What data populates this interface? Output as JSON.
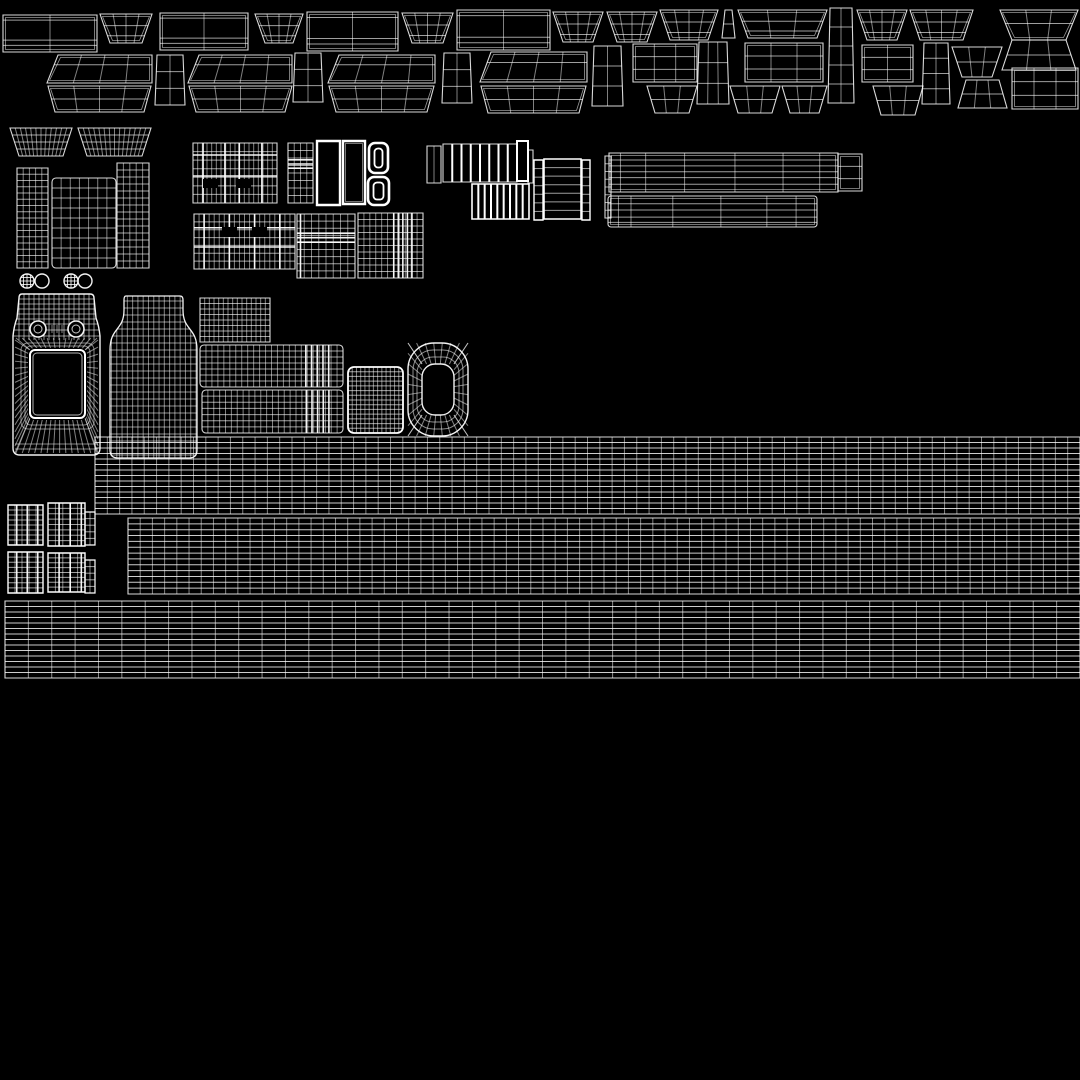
{
  "canvas": {
    "width": 1080,
    "height": 1080,
    "background": "#000000"
  },
  "style": {
    "line_color": "#ffffff",
    "border_opacity": 0.85,
    "bright_opacity": 1.0,
    "dim_opacity": 0.5,
    "row_opacity": 0.62
  },
  "shapes": [
    {
      "id": "panel-rect-1",
      "t": "rect",
      "x": 3,
      "y": 15,
      "w": 94,
      "h": 37,
      "colsAt": [
        0.5
      ],
      "rowsAt": [
        0.14,
        0.68,
        0.82
      ],
      "inset": true
    },
    {
      "id": "trapezoid-1",
      "t": "trap",
      "x": 100,
      "y": 14,
      "w": 52,
      "h": 29,
      "bi": 10,
      "colsAt": [
        0.25,
        0.5,
        0.75
      ],
      "rowsAt": [
        0.4,
        0.75
      ],
      "inset": true
    },
    {
      "id": "panel-rect-2",
      "t": "rect",
      "x": 160,
      "y": 13,
      "w": 88,
      "h": 37,
      "colsAt": [
        0.5
      ],
      "rowsAt": [
        0.14,
        0.68,
        0.82
      ],
      "inset": true
    },
    {
      "id": "trapezoid-2",
      "t": "trap",
      "x": 255,
      "y": 14,
      "w": 48,
      "h": 29,
      "bi": 10,
      "colsAt": [
        0.25,
        0.5,
        0.75
      ],
      "rowsAt": [
        0.4,
        0.75
      ],
      "inset": true
    },
    {
      "id": "panel-rect-3",
      "t": "rect",
      "x": 307,
      "y": 12,
      "w": 91,
      "h": 39,
      "colsAt": [
        0.5
      ],
      "rowsAt": [
        0.14,
        0.68,
        0.82
      ],
      "inset": true
    },
    {
      "id": "trapezoid-3",
      "t": "trap",
      "x": 402,
      "y": 13,
      "w": 51,
      "h": 30,
      "bi": 10,
      "colsAt": [
        0.25,
        0.5,
        0.75
      ],
      "rowsAt": [
        0.4,
        0.75
      ],
      "inset": true
    },
    {
      "id": "panel-rect-4",
      "t": "rect",
      "x": 457,
      "y": 10,
      "w": 93,
      "h": 40,
      "colsAt": [
        0.5
      ],
      "rowsAt": [
        0.14,
        0.68,
        0.82
      ],
      "inset": true
    },
    {
      "id": "trapezoid-4",
      "t": "trap",
      "x": 553,
      "y": 12,
      "w": 50,
      "h": 30,
      "bi": 10,
      "colsAt": [
        0.25,
        0.5,
        0.75
      ],
      "rowsAt": [
        0.4,
        0.75
      ],
      "inset": true
    },
    {
      "id": "trapezoid-5",
      "t": "trap",
      "x": 607,
      "y": 12,
      "w": 50,
      "h": 30,
      "bi": 10,
      "colsAt": [
        0.25,
        0.5,
        0.75
      ],
      "rowsAt": [
        0.4,
        0.75
      ],
      "inset": true
    },
    {
      "id": "trapezoid-6",
      "t": "trap",
      "x": 660,
      "y": 10,
      "w": 58,
      "h": 30,
      "bi": 10,
      "colsAt": [
        0.25,
        0.5,
        0.75
      ],
      "rowsAt": [
        0.4,
        0.75
      ],
      "inset": true
    },
    {
      "id": "edge-quad-1",
      "t": "trap",
      "x": 722,
      "y": 10,
      "w": 13,
      "h": 28,
      "ti": 3,
      "rows": 2
    },
    {
      "id": "trapezoid-wide-1",
      "t": "trap",
      "x": 738,
      "y": 10,
      "w": 89,
      "h": 28,
      "bi": 10,
      "colsAt": [
        0.33,
        0.66
      ],
      "rowsAt": [
        0.4,
        0.75
      ],
      "inset": true
    },
    {
      "id": "trapezoid-7",
      "t": "trap",
      "x": 857,
      "y": 10,
      "w": 50,
      "h": 30,
      "bi": 10,
      "colsAt": [
        0.25,
        0.5,
        0.75
      ],
      "rowsAt": [
        0.4,
        0.75
      ],
      "inset": true
    },
    {
      "id": "trapezoid-8",
      "t": "trap",
      "x": 910,
      "y": 10,
      "w": 63,
      "h": 30,
      "bi": 10,
      "colsAt": [
        0.25,
        0.5,
        0.75
      ],
      "rowsAt": [
        0.4,
        0.75
      ],
      "inset": true
    },
    {
      "id": "hourglass-top",
      "t": "trap",
      "x": 1000,
      "y": 10,
      "w": 78,
      "h": 30,
      "bi": 12,
      "colsAt": [
        0.33,
        0.66
      ],
      "rowsAt": [
        0.45
      ],
      "inset": true
    },
    {
      "id": "hourglass-bottom",
      "t": "trap",
      "x": 1000,
      "y": 40,
      "w": 78,
      "h": 30,
      "ti": 12,
      "bi": 2,
      "colsAt": [
        0.33,
        0.66
      ],
      "rowsAt": [
        0.5
      ]
    },
    {
      "id": "pair1-top",
      "t": "trap",
      "x": 47,
      "y": 55,
      "w": 105,
      "h": 28,
      "ti": 5.5,
      "sk": 5.5,
      "cols": 4,
      "rowsAt": [
        0.35
      ],
      "inset": true
    },
    {
      "id": "pair1-bottom",
      "t": "trap",
      "x": 48,
      "y": 86,
      "w": 103,
      "h": 26,
      "bi": 7,
      "cols": 4,
      "rowsAt": [
        0.5
      ],
      "inset": true
    },
    {
      "id": "side-quad-1",
      "t": "trap",
      "x": 155,
      "y": 55,
      "w": 30,
      "h": 50,
      "ti": 2,
      "cols": 2,
      "rows": 3
    },
    {
      "id": "pair2-top",
      "t": "trap",
      "x": 188,
      "y": 55,
      "w": 104,
      "h": 28,
      "ti": 5.5,
      "sk": 5.5,
      "cols": 4,
      "rowsAt": [
        0.35
      ],
      "inset": true
    },
    {
      "id": "pair2-bottom",
      "t": "trap",
      "x": 189,
      "y": 86,
      "w": 103,
      "h": 26,
      "bi": 7,
      "cols": 4,
      "rowsAt": [
        0.5
      ],
      "inset": true
    },
    {
      "id": "side-quad-2",
      "t": "trap",
      "x": 293,
      "y": 53,
      "w": 30,
      "h": 49,
      "ti": 2,
      "cols": 2,
      "rows": 3
    },
    {
      "id": "pair3-top",
      "t": "trap",
      "x": 328,
      "y": 55,
      "w": 107,
      "h": 28,
      "ti": 5.5,
      "sk": 5.5,
      "cols": 4,
      "rowsAt": [
        0.35
      ],
      "inset": true
    },
    {
      "id": "pair3-bottom",
      "t": "trap",
      "x": 329,
      "y": 86,
      "w": 105,
      "h": 26,
      "bi": 7,
      "cols": 4,
      "rowsAt": [
        0.5
      ],
      "inset": true
    },
    {
      "id": "side-quad-3",
      "t": "trap",
      "x": 442,
      "y": 53,
      "w": 30,
      "h": 50,
      "ti": 2,
      "cols": 2,
      "rows": 3
    },
    {
      "id": "pair4-top",
      "t": "trap",
      "x": 480,
      "y": 52,
      "w": 107,
      "h": 30,
      "ti": 5.5,
      "sk": 5.5,
      "cols": 4,
      "rowsAt": [
        0.35
      ],
      "inset": true
    },
    {
      "id": "pair4-bottom",
      "t": "trap",
      "x": 481,
      "y": 86,
      "w": 105,
      "h": 27,
      "bi": 7,
      "cols": 4,
      "rowsAt": [
        0.5
      ],
      "inset": true
    },
    {
      "id": "side-quad-4",
      "t": "trap",
      "x": 592,
      "y": 46,
      "w": 31,
      "h": 60,
      "ti": 2,
      "cols": 2,
      "rows": 3
    },
    {
      "id": "grid-rect-1",
      "t": "rect",
      "x": 633,
      "y": 44,
      "w": 64,
      "h": 38,
      "cols": 3,
      "rows": 3,
      "inset": true
    },
    {
      "id": "small-trap-1",
      "t": "trap",
      "x": 647,
      "y": 86,
      "w": 50,
      "h": 27,
      "bi": 8,
      "cols": 3,
      "rows": 2
    },
    {
      "id": "side-quad-5",
      "t": "trap",
      "x": 697,
      "y": 42,
      "w": 32,
      "h": 62,
      "ti": 2,
      "cols": 3,
      "rows": 3
    },
    {
      "id": "grid-rect-2",
      "t": "rect",
      "x": 745,
      "y": 43,
      "w": 78,
      "h": 39,
      "cols": 3,
      "rows": 3,
      "inset": true
    },
    {
      "id": "small-trap-2",
      "t": "trap",
      "x": 730,
      "y": 86,
      "w": 50,
      "h": 27,
      "bi": 8,
      "cols": 3,
      "rows": 2
    },
    {
      "id": "small-trap-3",
      "t": "trap",
      "x": 782,
      "y": 86,
      "w": 45,
      "h": 27,
      "bi": 8,
      "cols": 3,
      "rows": 2
    },
    {
      "id": "tall-panel-1",
      "t": "trap",
      "x": 828,
      "y": 8,
      "w": 26,
      "h": 95,
      "ti": 2,
      "cols": 2,
      "rows": 5
    },
    {
      "id": "grid-rect-3",
      "t": "rect",
      "x": 862,
      "y": 45,
      "w": 51,
      "h": 37,
      "cols": 2,
      "rows": 3,
      "inset": true
    },
    {
      "id": "small-trap-4",
      "t": "trap",
      "x": 873,
      "y": 86,
      "w": 50,
      "h": 29,
      "bi": 8,
      "cols": 3,
      "rows": 2
    },
    {
      "id": "tall-panel-2",
      "t": "trap",
      "x": 922,
      "y": 43,
      "w": 28,
      "h": 61,
      "ti": 2,
      "cols": 2,
      "rows": 4
    },
    {
      "id": "small-trap-5",
      "t": "trap",
      "x": 952,
      "y": 47,
      "w": 50,
      "h": 30,
      "bi": 10,
      "cols": 3,
      "rows": 2
    },
    {
      "id": "small-trap-6",
      "t": "trap",
      "x": 958,
      "y": 80,
      "w": 49,
      "h": 28,
      "ti": 8,
      "cols": 3,
      "rows": 2
    },
    {
      "id": "grid-rect-4",
      "t": "rect",
      "x": 1012,
      "y": 68,
      "w": 66,
      "h": 41,
      "cols": 3,
      "rows": 3,
      "inset": true
    },
    {
      "id": "dense-trap-1",
      "t": "trap",
      "x": 10,
      "y": 128,
      "w": 62,
      "h": 28,
      "bi": 9,
      "cols": 12,
      "rows": 4
    },
    {
      "id": "dense-trap-2",
      "t": "trap",
      "x": 78,
      "y": 128,
      "w": 73,
      "h": 28,
      "bi": 9,
      "cols": 14,
      "rows": 4
    },
    {
      "id": "curved-panel-left",
      "t": "rect",
      "x": 17,
      "y": 168,
      "w": 31,
      "h": 100,
      "cols": 5,
      "rows": 16
    },
    {
      "id": "curved-panel-mid",
      "t": "rect",
      "x": 52,
      "y": 178,
      "w": 64,
      "h": 90,
      "rx": 4,
      "cols": 7,
      "rows": 9
    },
    {
      "id": "curved-panel-right",
      "t": "rect",
      "x": 117,
      "y": 163,
      "w": 32,
      "h": 105,
      "cols": 5,
      "rows": 15
    },
    {
      "id": "eyelet-circle-1",
      "t": "circle",
      "x": 27,
      "y": 281,
      "r": 7,
      "hatch": true
    },
    {
      "id": "eyelet-circle-2",
      "t": "circle",
      "x": 42,
      "y": 281,
      "r": 7
    },
    {
      "id": "eyelet-circle-3",
      "t": "circle",
      "x": 71,
      "y": 281,
      "r": 7,
      "hatch": true
    },
    {
      "id": "eyelet-circle-4",
      "t": "circle",
      "x": 85,
      "y": 281,
      "r": 7
    },
    {
      "id": "plaid-block-a",
      "t": "rect",
      "x": 193,
      "y": 143,
      "w": 84,
      "h": 60,
      "cols": 18,
      "rows": 7,
      "colsB": [
        0.12,
        0.38,
        0.55,
        0.82
      ],
      "rowsB": [
        0.2,
        0.55
      ],
      "slots": [
        [
          10,
          36,
          15,
          9
        ],
        [
          43,
          36,
          15,
          9
        ]
      ]
    },
    {
      "id": "plaid-strip-a",
      "t": "rect",
      "x": 288,
      "y": 143,
      "w": 25,
      "h": 60,
      "cols": 4,
      "rows": 8,
      "rowsB": [
        0.28,
        0.35,
        0.42
      ]
    },
    {
      "id": "white-frame-1",
      "t": "rect",
      "x": 317,
      "y": 141,
      "w": 23,
      "h": 64,
      "b": "hi",
      "lw": 2.4
    },
    {
      "id": "white-frame-2",
      "t": "rect",
      "x": 343,
      "y": 141,
      "w": 22,
      "h": 63,
      "b": "hi",
      "lw": 2.4,
      "inset": true
    },
    {
      "id": "grommet-ring-1",
      "t": "ringrr",
      "x": 369,
      "y": 143,
      "w": 19,
      "h": 30
    },
    {
      "id": "grommet-ring-2",
      "t": "ringrr",
      "x": 368,
      "y": 177,
      "w": 21,
      "h": 28
    },
    {
      "id": "plaid-block-b",
      "t": "rect",
      "x": 194,
      "y": 214,
      "w": 101,
      "h": 55,
      "cols": 20,
      "rows": 7,
      "colsB": [
        0.1,
        0.35,
        0.6,
        0.85
      ],
      "rowsB": [
        0.25,
        0.6
      ],
      "slots": [
        [
          28,
          13,
          15,
          10
        ],
        [
          58,
          13,
          15,
          10
        ]
      ]
    },
    {
      "id": "plaid-block-c",
      "t": "rect",
      "x": 297,
      "y": 214,
      "w": 58,
      "h": 64,
      "cols": 8,
      "rows": 9,
      "colsB": [
        0.06
      ],
      "rowsB": [
        0.3,
        0.37,
        0.44
      ]
    },
    {
      "id": "plaid-block-d",
      "t": "rect",
      "x": 358,
      "y": 213,
      "w": 65,
      "h": 65,
      "cols": 11,
      "rows": 10,
      "colsB": [
        0.55,
        0.62,
        0.69,
        0.76,
        0.83
      ]
    },
    {
      "id": "stripe-strip-1",
      "t": "rect",
      "x": 427,
      "y": 146,
      "w": 14,
      "h": 37,
      "cols": 2
    },
    {
      "id": "barcode-block",
      "t": "rect",
      "x": 443,
      "y": 144,
      "w": 74,
      "h": 38,
      "bars": 8
    },
    {
      "id": "bright-bar-1",
      "t": "rect",
      "x": 517,
      "y": 141,
      "w": 11,
      "h": 40,
      "b": "hi",
      "lw": 2
    },
    {
      "id": "dim-bar-1",
      "t": "rect",
      "x": 528,
      "y": 150,
      "w": 5,
      "h": 33
    },
    {
      "id": "comb-block",
      "t": "rect",
      "x": 472,
      "y": 184,
      "w": 57,
      "h": 35,
      "bars": 9,
      "b": "hi",
      "lw": 1.6
    },
    {
      "id": "ladder-small-1",
      "t": "rect",
      "x": 534,
      "y": 160,
      "w": 9,
      "h": 60,
      "rows": 7,
      "b": "hi",
      "lw": 1.4
    },
    {
      "id": "ladder-large",
      "t": "rect",
      "x": 544,
      "y": 159,
      "w": 37,
      "h": 60,
      "rows": 7,
      "b": "hi",
      "lw": 1.6
    },
    {
      "id": "ladder-small-2",
      "t": "rect",
      "x": 582,
      "y": 160,
      "w": 8,
      "h": 60,
      "rows": 7,
      "b": "hi",
      "lw": 1.4
    },
    {
      "id": "thin-strip-1",
      "t": "rect",
      "x": 605,
      "y": 156,
      "w": 6,
      "h": 62,
      "rows": 8
    },
    {
      "id": "long-bar-1",
      "t": "rect",
      "x": 609,
      "y": 153,
      "w": 229,
      "h": 39,
      "rowsAt": [
        0.18,
        0.33,
        0.48,
        0.63,
        0.8
      ],
      "colsAt": [
        0.05,
        0.16,
        0.33,
        0.55,
        0.76,
        0.92
      ],
      "inset": true
    },
    {
      "id": "long-bar-1-end",
      "t": "rect",
      "x": 838,
      "y": 154,
      "w": 24,
      "h": 37,
      "rows": 3,
      "inset": true
    },
    {
      "id": "long-bar-2",
      "t": "rect",
      "x": 608,
      "y": 196,
      "w": 209,
      "h": 31,
      "rx": 3,
      "rowsAt": [
        0.25,
        0.45,
        0.68,
        0.85
      ],
      "colsAt": [
        0.05,
        0.11,
        0.31,
        0.54,
        0.76,
        0.9
      ],
      "inset": true
    },
    {
      "id": "bag-front-mesh",
      "t": "bag",
      "x": 13,
      "y": 293,
      "w": 87,
      "h": 162
    },
    {
      "id": "bottle-mesh",
      "t": "bottle",
      "x": 110,
      "y": 295,
      "w": 87,
      "h": 163
    },
    {
      "id": "grid-block-a",
      "t": "rect",
      "x": 200,
      "y": 298,
      "w": 70,
      "h": 44,
      "cols": 15,
      "rows": 8
    },
    {
      "id": "grid-block-b",
      "t": "rect",
      "x": 200,
      "y": 345,
      "w": 143,
      "h": 42,
      "rx": 4,
      "cols": 24,
      "rows": 7,
      "colsB": [
        0.74,
        0.78,
        0.82,
        0.86,
        0.9
      ]
    },
    {
      "id": "grid-block-c",
      "t": "rect",
      "x": 202,
      "y": 390,
      "w": 141,
      "h": 43,
      "rx": 4,
      "cols": 24,
      "rows": 7,
      "colsB": [
        0.74,
        0.78,
        0.82,
        0.86,
        0.9
      ]
    },
    {
      "id": "cup-mesh",
      "t": "rect",
      "x": 348,
      "y": 367,
      "w": 55,
      "h": 66,
      "rx": 6,
      "cols": 13,
      "rows": 14,
      "b": "hi",
      "lw": 1.8
    },
    {
      "id": "ring-o-mesh",
      "t": "ringO",
      "x": 408,
      "y": 343,
      "w": 60,
      "h": 93
    },
    {
      "id": "grid-band-1",
      "t": "rect",
      "x": 95,
      "y": 437,
      "w": 985,
      "h": 77,
      "cols": 80,
      "rows": 14,
      "co": 0.5,
      "ro": 0.8
    },
    {
      "id": "grid-band-2",
      "t": "rect",
      "x": 128,
      "y": 518,
      "w": 952,
      "h": 76,
      "cols": 78,
      "rows": 13,
      "co": 0.5,
      "ro": 0.8
    },
    {
      "id": "grid-band-3",
      "t": "rect",
      "x": 5,
      "y": 601,
      "w": 1075,
      "h": 77,
      "cols": 46,
      "rows": 14,
      "co": 0.55,
      "ro": 0.8
    },
    {
      "id": "cluster-block-1",
      "t": "rect",
      "x": 8,
      "y": 505,
      "w": 35,
      "h": 40,
      "cols": 5,
      "rows": 8,
      "colsB": [
        0.25,
        0.55,
        0.85
      ],
      "b": "hi",
      "lw": 1.4
    },
    {
      "id": "cluster-block-2",
      "t": "rect",
      "x": 48,
      "y": 503,
      "w": 37,
      "h": 43,
      "cols": 5,
      "rows": 8,
      "colsB": [
        0.3,
        0.6,
        0.9
      ],
      "b": "hi",
      "lw": 1.4
    },
    {
      "id": "cluster-strip-1",
      "t": "rect",
      "x": 85,
      "y": 512,
      "w": 10,
      "h": 33,
      "cols": 2,
      "rows": 5,
      "b": "hi",
      "lw": 1.2
    },
    {
      "id": "cluster-block-3",
      "t": "rect",
      "x": 8,
      "y": 552,
      "w": 35,
      "h": 41,
      "cols": 5,
      "rows": 8,
      "colsB": [
        0.25,
        0.55,
        0.85
      ],
      "b": "hi",
      "lw": 1.4
    },
    {
      "id": "cluster-block-4",
      "t": "rect",
      "x": 48,
      "y": 553,
      "w": 37,
      "h": 39,
      "cols": 5,
      "rows": 8,
      "colsB": [
        0.3,
        0.6,
        0.9
      ],
      "b": "hi",
      "lw": 1.4
    },
    {
      "id": "cluster-strip-2",
      "t": "rect",
      "x": 85,
      "y": 560,
      "w": 10,
      "h": 33,
      "cols": 2,
      "rows": 5,
      "b": "hi",
      "lw": 1.2
    }
  ]
}
